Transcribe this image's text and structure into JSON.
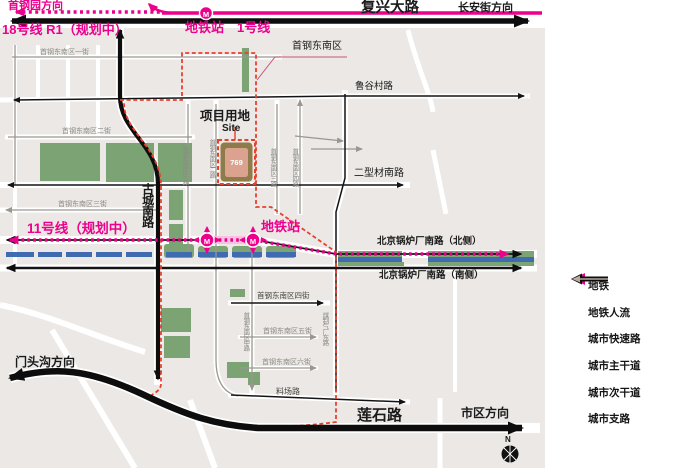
{
  "map": {
    "labels": {
      "shougang_direction": "首钢园方向",
      "line18": "18号线 R1（规划中）",
      "metro_station_top": "地铁站",
      "line1": "1号线",
      "fuxing_ave": "复兴大路",
      "changan_direction": "长安街方向",
      "street1": "首钢东南区一街",
      "shougang_se_district": "首钢东南区",
      "lugu_rd": "鲁谷村路",
      "site_label_cn": "项目用地",
      "site_label_en": "Site",
      "site_number": "769",
      "street2": "首钢东南区二街",
      "erxingcai_rd": "二型材南路",
      "street3": "首钢东南区三街",
      "line11": "11号线（规划中）",
      "gucheng_rd": "古城南路",
      "metro_station_mid": "地铁站",
      "boiler_rd_north": "北京锅炉厂南路（北侧）",
      "boiler_rd_south": "北京锅炉厂南路（南侧）",
      "street4": "首钢东南区四街",
      "street5": "首钢东南区五街",
      "street6": "首钢东南区六街",
      "liaochang_rd": "料场路",
      "mentougou_direction": "门头沟方向",
      "lianshi_rd": "莲石路",
      "city_direction": "市区方向",
      "compass_n": "N",
      "road_v1": "首钢东南区一路",
      "road_v2": "首钢东南区二路",
      "road_v3": "首钢东南区三路",
      "road_v4": "首钢东南区四路",
      "road_mid": "首钢东南区中路",
      "meizhiqi_rd": "煤制气厂东路",
      "station_m": "M"
    }
  },
  "legend": {
    "items": [
      {
        "label": "地铁"
      },
      {
        "label": "地铁人流"
      },
      {
        "label": "城市快速路"
      },
      {
        "label": "城市主干道"
      },
      {
        "label": "城市次干道"
      },
      {
        "label": "城市支路"
      }
    ]
  },
  "colors": {
    "metro_pink": "#ec008c",
    "boundary_red": "#e8402d",
    "green_area": "#7ca374",
    "water_blue": "#3f6cb0",
    "site_outer": "#8d7b4a",
    "site_inner": "#dba38f",
    "road_black": "#0d0d0d",
    "road_gray": "#9a9790",
    "branch_gray": "#b2ad9c",
    "block_gray": "#ebe8e5"
  }
}
